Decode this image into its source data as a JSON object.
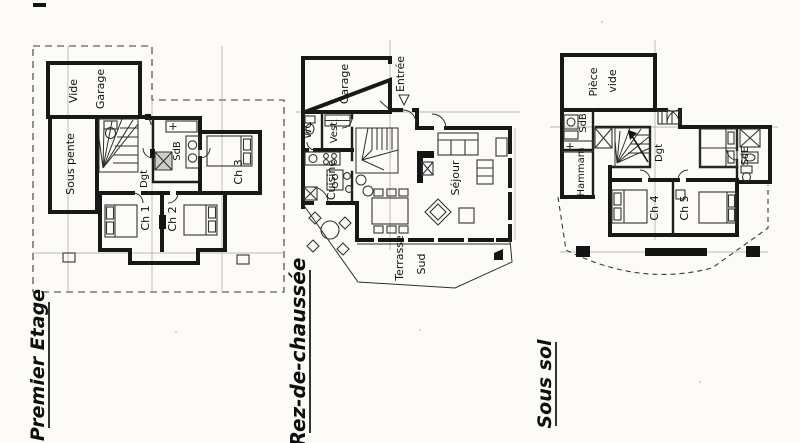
{
  "palette": {
    "paper": "#fcfbf7",
    "ink": "#1a1a1a"
  },
  "plans": {
    "premier": {
      "title": "Premier Etage",
      "rooms": {
        "vide": "Vide",
        "garage": "Garage",
        "sous_pente": "Sous pente",
        "sdb": "SdB",
        "dgt": "Dgt",
        "ch1": "Ch 1",
        "ch2": "Ch 2",
        "ch3": "Ch 3"
      }
    },
    "rdc": {
      "title": "Rez-de-chaussée",
      "rooms": {
        "garage": "Garage",
        "entree": "Entrée",
        "wc": "WC",
        "vest": "Vest.",
        "cuisine": "Cuisine",
        "sejour": "Séjour",
        "terrasse": "Terrasse",
        "sud": "Sud"
      }
    },
    "soussol": {
      "title": "Sous sol",
      "rooms": {
        "piece": "Pièce",
        "vide": "vide",
        "sdb": "SdB",
        "hammam": "Hammam",
        "dgt": "Dgt",
        "ch4": "Ch 4",
        "ch5": "Ch 5",
        "sde": "SdE"
      }
    }
  }
}
